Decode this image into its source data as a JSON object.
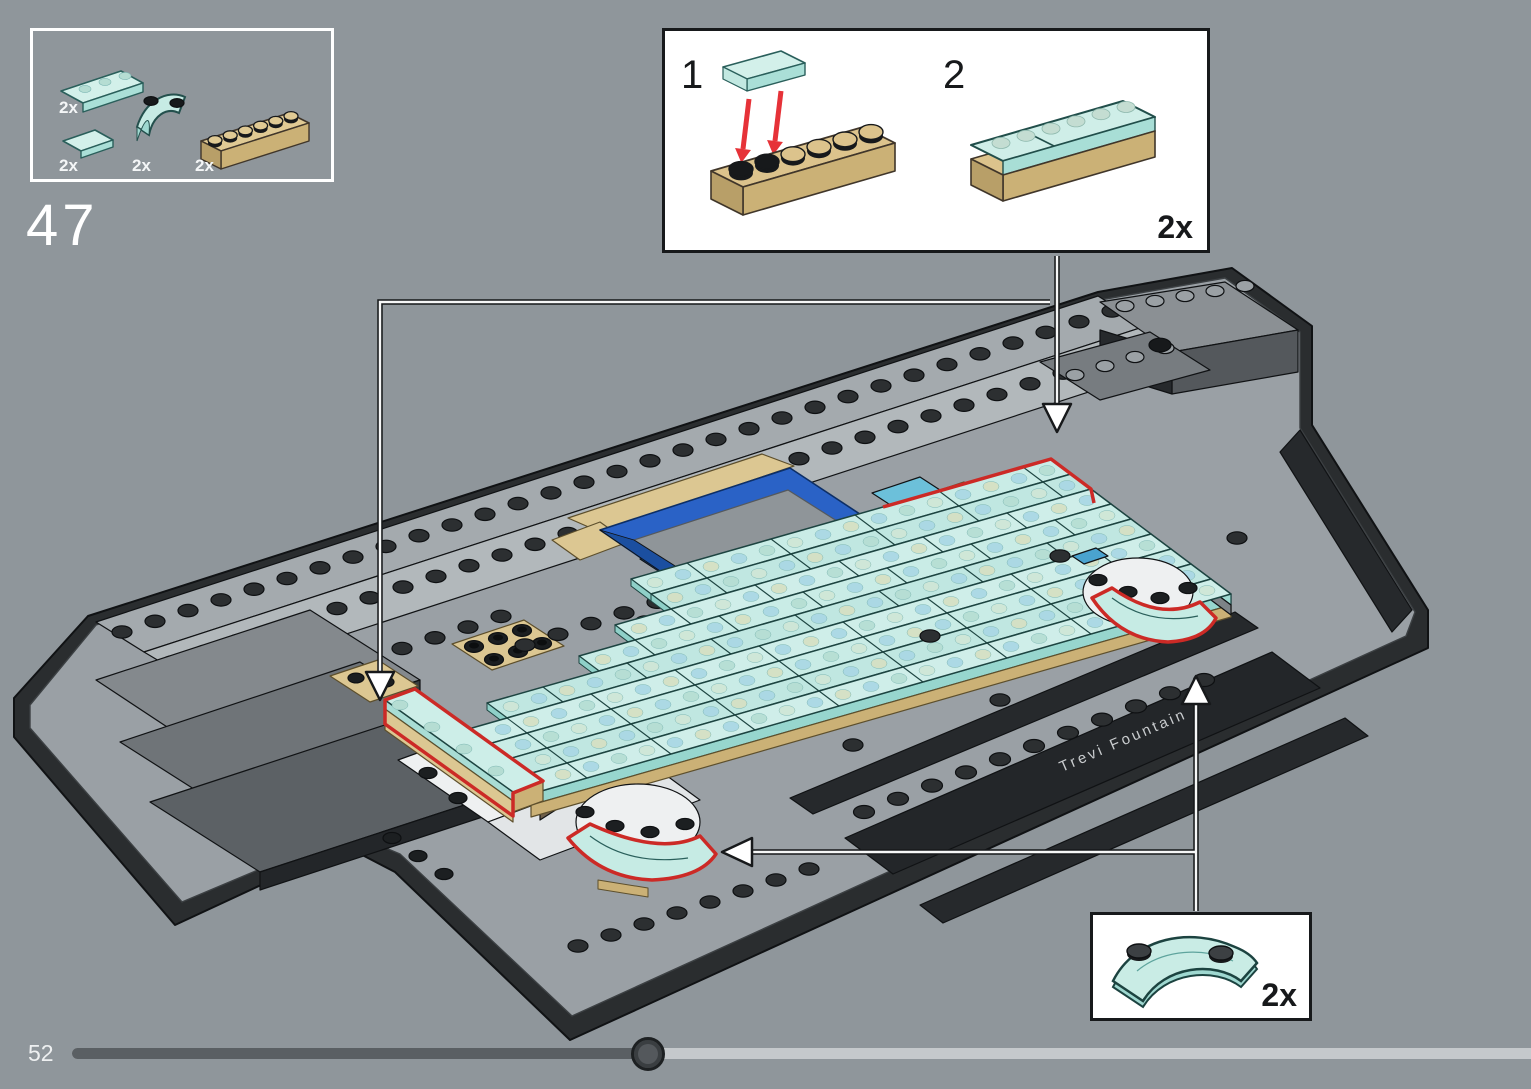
{
  "step": {
    "number": "47"
  },
  "parts_panel": {
    "items": [
      {
        "name": "trans-light-blue tile 1x4",
        "qty": "2x"
      },
      {
        "name": "trans-light-blue plate 1x2",
        "qty": "2x"
      },
      {
        "name": "trans-light-blue curved brick 2x2",
        "qty": "2x"
      },
      {
        "name": "tan brick 1x6",
        "qty": "2x"
      }
    ]
  },
  "substep_inset": {
    "steps": [
      {
        "label": "1"
      },
      {
        "label": "2"
      }
    ],
    "quantity": "2x"
  },
  "part_callout": {
    "quantity": "2x"
  },
  "model": {
    "printed_label": "Trevi Fountain"
  },
  "progress_bar": {
    "page_number": "52",
    "percent": 40
  },
  "colors": {
    "background": "#8f969b",
    "deck_grey": "#9aa0a5",
    "dark_edge": "#26292c",
    "glass_top": "#cdeee8",
    "glass_side": "#a8ded6",
    "glass_outline": "#1d4441",
    "tan": "#dcc792",
    "tan_dark": "#cbb176",
    "azure": "#6cc0da",
    "pool_blue": "#2a62c6",
    "highlight_red": "#cc2a26",
    "arrow_red": "#e63238",
    "white_plate": "#eef0f1",
    "track_filled": "#5a5f63",
    "track_empty": "#c5c9cc"
  }
}
